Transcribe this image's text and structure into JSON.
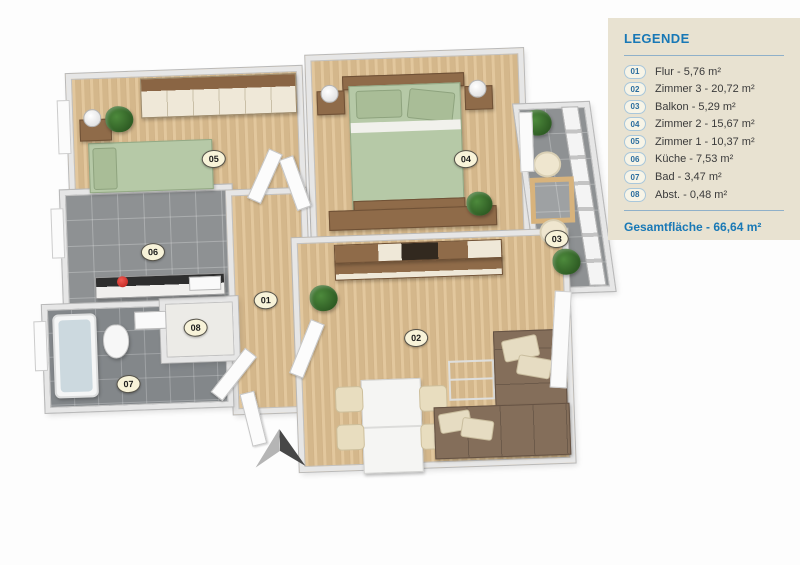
{
  "colors": {
    "accent_blue": "#1878b6",
    "panel_bg": "#e8e2d1",
    "wood_floor": "#dfc192",
    "tile_gray": "#8e9193",
    "bed_green": "#b6c9a7",
    "sofa_brown": "#846e5a",
    "plan_badge_bg": "#f8f3d9"
  },
  "legend": {
    "title": "LEGENDE",
    "items": [
      {
        "num": "01",
        "label": "Flur - 5,76 m²"
      },
      {
        "num": "02",
        "label": "Zimmer 3 - 20,72 m²"
      },
      {
        "num": "03",
        "label": "Balkon - 5,29 m²"
      },
      {
        "num": "04",
        "label": "Zimmer 2 - 15,67 m²"
      },
      {
        "num": "05",
        "label": "Zimmer 1 - 10,37 m²"
      },
      {
        "num": "06",
        "label": "Küche - 7,53 m²"
      },
      {
        "num": "07",
        "label": "Bad - 3,47 m²"
      },
      {
        "num": "08",
        "label": "Abst. - 0,48 m²"
      }
    ],
    "total": "Gesamtfläche - 66,64 m²"
  },
  "plan": {
    "badges": [
      "01",
      "02",
      "03",
      "04",
      "05",
      "06",
      "07",
      "08"
    ]
  },
  "icons": {
    "north_arrow": "north-arrow"
  }
}
